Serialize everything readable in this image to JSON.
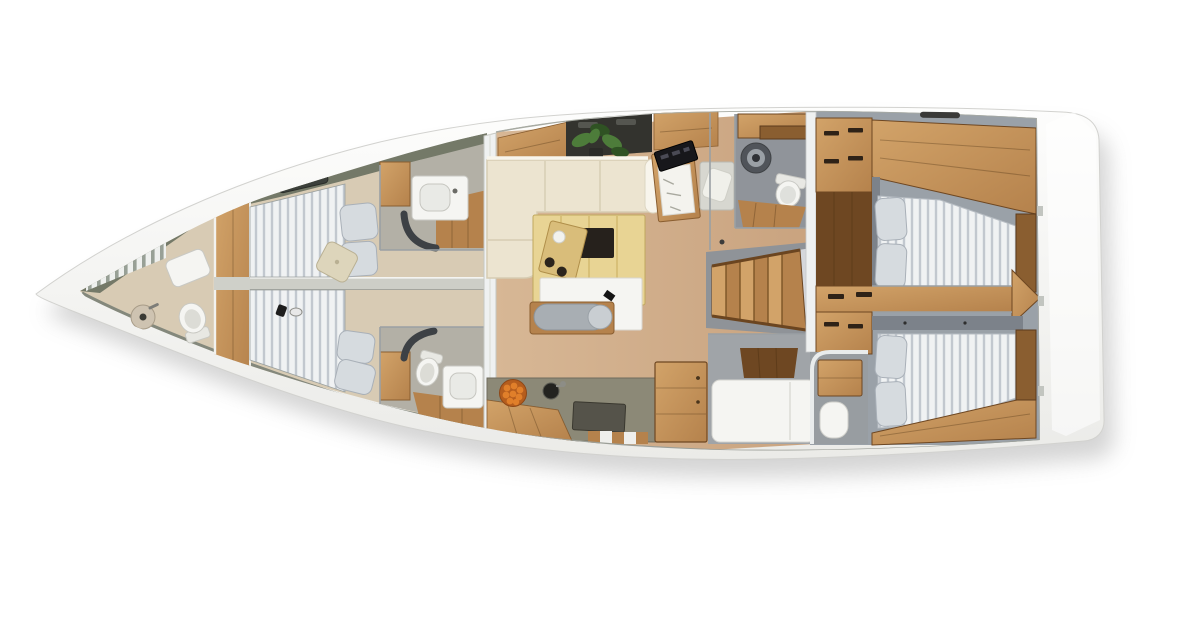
{
  "scene": {
    "type": "yacht-interior-floor-plan",
    "view": "top-down-3d-render",
    "orientation": {
      "bow": "left",
      "stern": "right"
    },
    "background": "#ffffff"
  },
  "palette": {
    "page_bg": "#ffffff",
    "hull_deck_hi": "#fdfdfc",
    "hull_deck_lo": "#ebebe8",
    "hull_edge": "#d2d2cf",
    "hull_wall": "#747968",
    "wood": "#b5824c",
    "wood_dark": "#8a5e30",
    "wood_deep": "#6e4722",
    "wood_light": "#d2a369",
    "floor_tan": "#d7b795",
    "floor_tan_dark": "#c9a37f",
    "floor_beige": "#d8cbb4",
    "head_floor": "#b3b0a6",
    "counter_gray": "#8c8977",
    "counter_dark": "#55534a",
    "sofa_cream": "#ece4d0",
    "sofa_edge": "#d6ccb2",
    "sofa_hi": "#f8f5ec",
    "table_wood": "#e8d494",
    "table_inset": "#26211c",
    "board_wood": "#d9bd7a",
    "mattress_white": "#f0f2f3",
    "mattress_gap": "#c2c8cf",
    "slat_white": "#eef0ee",
    "slat_gap": "#98a096",
    "bed_platform": "#9aa1a8",
    "headboard": "#7c828a",
    "pillow_gray": "#d6dbdf",
    "pillow_edge": "#a9b0b8",
    "pillow_beige": "#ddd5bb",
    "fixture_white": "#f5f5f2",
    "fixture_edge": "#c9c9c4",
    "wall_gray": "#9aa0a4",
    "wall_light": "#c6c9cb",
    "room_gray": "#90949a",
    "white_band": "#eff1f1",
    "dark_cabinet": "#33332e",
    "plant_green": "#4d7c3a",
    "plant_dark": "#2f5223",
    "orange": "#e07f2a",
    "orange_deep": "#b55d1d",
    "shadow": "#9a9a9a"
  },
  "rooms": [
    {
      "id": "forepeak-head",
      "furniture": [
        "hull-ceiling-slats",
        "seat-cushion",
        "washbasin",
        "toilet"
      ]
    },
    {
      "id": "forward-cabin-port",
      "furniture": [
        "slatted-berth",
        "gray-pillow",
        "gray-pillow",
        "beige-throw-pillow",
        "deck-hatch"
      ]
    },
    {
      "id": "forward-cabin-starboard",
      "furniture": [
        "slatted-berth",
        "gray-pillow",
        "gray-pillow",
        "personal-items"
      ]
    },
    {
      "id": "forward-head-port",
      "furniture": [
        "locker",
        "washbasin-counter",
        "shower-partition",
        "wood-floor"
      ]
    },
    {
      "id": "forward-head-starboard",
      "furniture": [
        "locker",
        "toilet",
        "washbasin-counter",
        "shower-partition",
        "wood-floor"
      ]
    },
    {
      "id": "saloon",
      "furniture": [
        "overhead-lockers",
        "potted-plant",
        "l-shaped-sofa",
        "dining-table",
        "serving-board",
        "sideboard",
        "bench-seat",
        "bolster-cushion"
      ]
    },
    {
      "id": "galley",
      "furniture": [
        "countertop",
        "sink",
        "stove",
        "fruit-bowl",
        "drawers",
        "tall-cabinet",
        "wood-counter"
      ]
    },
    {
      "id": "nav-station",
      "furniture": [
        "chart-table",
        "chart",
        "instrument-panel",
        "seat"
      ]
    },
    {
      "id": "aft-head-port",
      "furniture": [
        "shelves",
        "washing-machine",
        "toilet",
        "wood-floor"
      ]
    },
    {
      "id": "companionway",
      "furniture": [
        "stairs"
      ]
    },
    {
      "id": "mid-cabin",
      "furniture": [
        "berth",
        "wood-floor",
        "washbasin"
      ]
    },
    {
      "id": "aft-cabin-port",
      "furniture": [
        "wardrobe",
        "entry-floor",
        "overhead-shelf",
        "double-berth",
        "gray-pillow",
        "gray-pillow"
      ]
    },
    {
      "id": "aft-cabin-starboard",
      "furniture": [
        "wardrobe",
        "washbasin",
        "overhead-shelf",
        "double-berth",
        "gray-pillow",
        "gray-pillow"
      ]
    },
    {
      "id": "divider-console",
      "furniture": [
        "drawers",
        "corner-shelf"
      ]
    },
    {
      "id": "stern-deck",
      "furniture": [
        "transom"
      ]
    }
  ]
}
